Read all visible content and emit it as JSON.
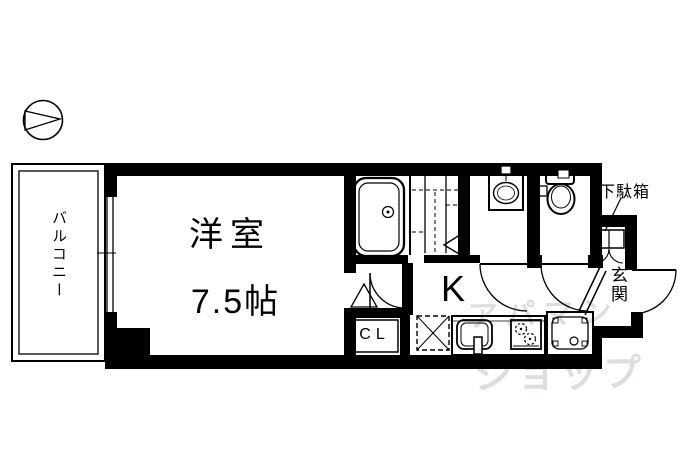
{
  "plan": {
    "compass": "north-arrow",
    "balcony": {
      "label": "バルコニー"
    },
    "main_room": {
      "label": "洋室",
      "size": "7.5帖"
    },
    "kitchen": {
      "label": "K"
    },
    "closet": {
      "label": "CL"
    },
    "entrance": {
      "label": "玄関"
    },
    "shoe_cabinet": {
      "label": "下駄箱"
    },
    "fixtures": [
      "bathtub",
      "washbasin",
      "toilet",
      "kitchen-sink",
      "gas-stove",
      "refrigerator-space",
      "washing-machine-space",
      "shoe-cabinet",
      "sliding-window",
      "hinged-doors"
    ],
    "colors": {
      "walls": "#000000",
      "background": "#ffffff",
      "watermark": "#dcdfe2"
    }
  },
  "watermark": {
    "line1": "アパマン",
    "line2": "ショップ"
  }
}
